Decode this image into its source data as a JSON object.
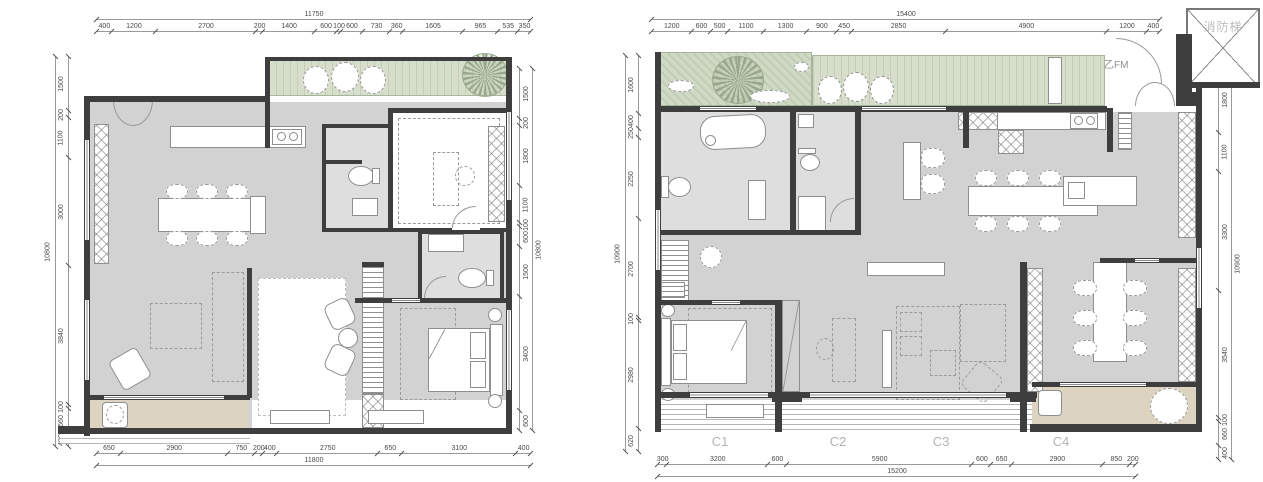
{
  "colors": {
    "wall": "#3e3e3e",
    "floor": "#d2d2d2",
    "bath_floor": "#dedede",
    "balcony": "#dcd4c1",
    "garden_green": "#d0d9c4",
    "deck_green": "#d7decb",
    "dim_text": "#4a4a4a",
    "unit_label_gray": "#b3b3b3"
  },
  "left_plan": {
    "dims": {
      "top": {
        "total": "11750",
        "segments": [
          "400",
          "1200",
          "2700",
          "200",
          "1400",
          "600",
          "100",
          "600",
          "730",
          "360",
          "1605",
          "965",
          "535",
          "350"
        ]
      },
      "bottom": {
        "total": "11800",
        "segments": [
          "650",
          "2900",
          "750",
          "200",
          "400",
          "2750",
          "650",
          "3100",
          "400"
        ]
      },
      "left": {
        "total": "10800",
        "segments": [
          "1500",
          "200",
          "1100",
          "3000",
          "3840",
          "100",
          "660",
          "400"
        ]
      },
      "right": {
        "total": "10800",
        "segments": [
          "1500",
          "200",
          "1800",
          "1100",
          "100",
          "600",
          "1500",
          "3400",
          "600"
        ]
      }
    }
  },
  "right_plan": {
    "dims": {
      "top": {
        "total": "15400",
        "segments": [
          "1200",
          "600",
          "500",
          "1100",
          "1300",
          "900",
          "450",
          "2850",
          "4900",
          "1200",
          "400"
        ]
      },
      "bottom": {
        "total": "15200",
        "segments": [
          "300",
          "3200",
          "600",
          "5900",
          "600",
          "650",
          "2900",
          "850",
          "200"
        ]
      },
      "left": {
        "total": "10900",
        "segments": [
          "1600",
          "400",
          "250",
          "2250",
          "2700",
          "100",
          "2980",
          "620"
        ]
      },
      "right": {
        "total": "10900",
        "segments": [
          "1800",
          "1100",
          "3300",
          "3540",
          "100",
          "660",
          "400"
        ]
      }
    },
    "unit_labels": [
      "C1",
      "C2",
      "C3",
      "C4"
    ],
    "fire_stair_label": "消防梯",
    "fire_door_label": "乙FM"
  }
}
